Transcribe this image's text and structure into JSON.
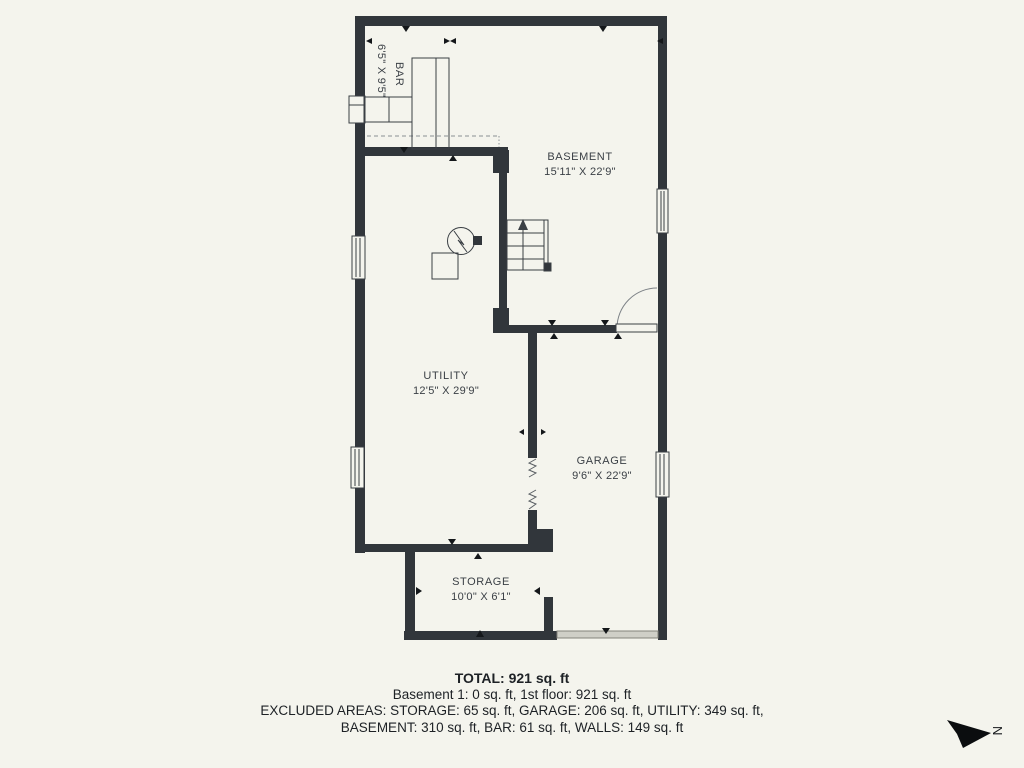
{
  "plan": {
    "rooms": [
      {
        "name": "BAR",
        "dims": "6'5\" X 9'5\""
      },
      {
        "name": "BASEMENT",
        "dims": "15'11\" X 22'9\""
      },
      {
        "name": "UTILITY",
        "dims": "12'5\" X 29'9\""
      },
      {
        "name": "GARAGE",
        "dims": "9'6\" X 22'9\""
      },
      {
        "name": "STORAGE",
        "dims": "10'0\" X 6'1\""
      }
    ],
    "compass": {
      "label": "N"
    }
  },
  "icons": {
    "water_heater": "circle-with-zigzag",
    "furnace": "square-outline",
    "stairs": "treads-with-up-arrow",
    "door": "quarter-arc-swing",
    "garage_door": "gray-band",
    "compass": "black-arrow-pointing-right"
  },
  "summary": {
    "total": "TOTAL: 921 sq. ft",
    "floors": "Basement 1: 0 sq. ft, 1st floor: 921 sq. ft",
    "excluded_line1": "EXCLUDED AREAS: STORAGE: 65 sq. ft, GARAGE: 206 sq. ft, UTILITY: 349 sq. ft,",
    "excluded_line2": "BASEMENT: 310 sq. ft, BAR: 61 sq. ft, WALLS: 149 sq. ft"
  },
  "colors": {
    "background": "#f4f4ed",
    "wall": "#31363b",
    "line": "#3a3f44",
    "garage_door": "#cfcfc7",
    "text": "#3a3f45"
  }
}
